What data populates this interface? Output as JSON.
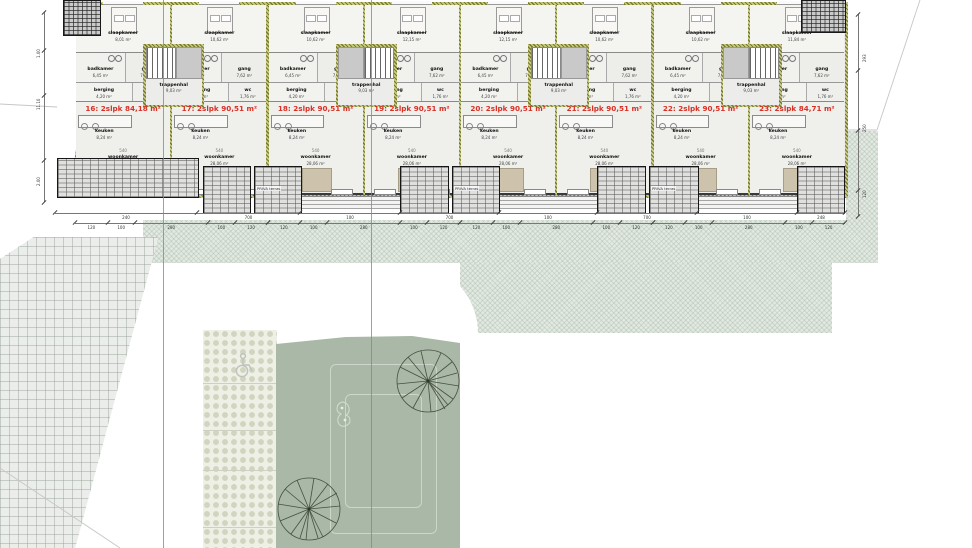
{
  "document": {
    "type": "architectural floor plan with site plan",
    "language": "nl"
  },
  "plan": {
    "units": [
      {
        "number": "16",
        "label": "16: 2slpk 84,18 m²",
        "slaapkamer_area": "8,01 m²",
        "woonkamer_area": "25,80 m²"
      },
      {
        "number": "17",
        "label": "17: 2slpk 90,51 m²",
        "slaapkamer_area": "10,62 m²",
        "woonkamer_area": "28,06 m²"
      },
      {
        "number": "18",
        "label": "18: 2slpk 90,51 m²",
        "slaapkamer_area": "10,62 m²",
        "woonkamer_area": "28,06 m²"
      },
      {
        "number": "19",
        "label": "19: 2slpk 90,51 m²",
        "slaapkamer_area": "12,15 m²",
        "woonkamer_area": "28,06 m²"
      },
      {
        "number": "20",
        "label": "20: 2slpk 90,51 m²",
        "slaapkamer_area": "12,15 m²",
        "woonkamer_area": "28,06 m²"
      },
      {
        "number": "21",
        "label": "21: 2slpk 90,51 m²",
        "slaapkamer_area": "10,62 m²",
        "woonkamer_area": "28,06 m²"
      },
      {
        "number": "22",
        "label": "22: 2slpk 90,51 m²",
        "slaapkamer_area": "10,62 m²",
        "woonkamer_area": "28,06 m²"
      },
      {
        "number": "23",
        "label": "23: 2slpk 84,71 m²",
        "slaapkamer_area": "11,84 m²",
        "woonkamer_area": "28,06 m²"
      }
    ],
    "rooms": {
      "slaapkamer": "slaapkamer",
      "badkamer": {
        "name": "badkamer",
        "area": "6,45 m²"
      },
      "gang": {
        "name": "gang",
        "area": "7,62 m²"
      },
      "trappenhal": {
        "name": "trappenhal",
        "area": "9,03 m²"
      },
      "berging": {
        "name": "berging",
        "area": "4,20 m²"
      },
      "wc": {
        "name": "wc",
        "area": "1,76 m²"
      },
      "keuken": {
        "name": "keuken",
        "area": "8,24 m²"
      },
      "woonkamer": "woonkamer"
    },
    "terrace_label": "PRIVA terras",
    "dimensions": {
      "bottom_main": [
        "240",
        "700",
        "100",
        "700",
        "100",
        "700",
        "100",
        "248"
      ],
      "bottom_steps": [
        "120",
        "100",
        "280",
        "100",
        "120"
      ],
      "left": [
        "1.00",
        "11.10",
        "2.00"
      ],
      "right": [
        "293",
        "250",
        "120"
      ],
      "interior_width": "540"
    },
    "accent_red": "#d93025"
  },
  "site": {
    "garden_color": "#a9b8a7",
    "features": [
      "grid-paving",
      "honeycomb-paving",
      "lawn-garden",
      "tree-symbols",
      "accessible-parking-icon",
      "blue-section-lines"
    ]
  }
}
